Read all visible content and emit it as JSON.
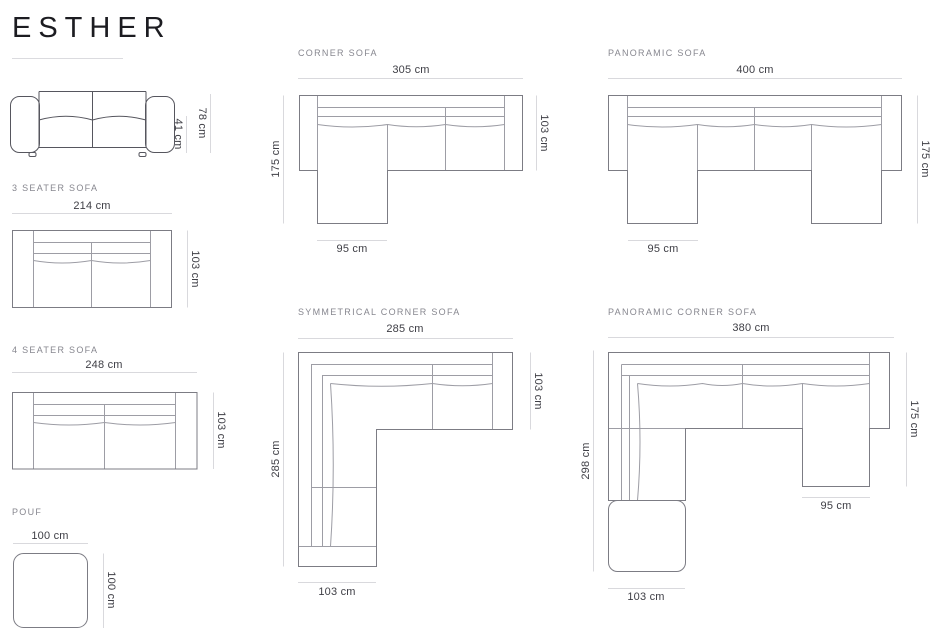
{
  "brand": {
    "title": "ESTHER"
  },
  "sections": {
    "front_view": {
      "dims": {
        "total_height": "78 cm",
        "seat_height": "41 cm"
      }
    },
    "three_seater": {
      "title": "3 SEATER SOFA",
      "dims": {
        "width": "214 cm",
        "depth": "103 cm"
      }
    },
    "four_seater": {
      "title": "4 SEATER SOFA",
      "dims": {
        "width": "248 cm",
        "depth": "103 cm"
      }
    },
    "pouf": {
      "title": "POUF",
      "dims": {
        "width": "100 cm",
        "depth": "100 cm"
      }
    },
    "corner": {
      "title": "CORNER SOFA",
      "dims": {
        "width": "305 cm",
        "left_depth": "175 cm",
        "right_depth": "103 cm",
        "chaise_width": "95 cm"
      }
    },
    "panoramic": {
      "title": "PANORAMIC SOFA",
      "dims": {
        "width": "400 cm",
        "right_depth": "175 cm",
        "chaise_width": "95 cm"
      }
    },
    "symmetrical_corner": {
      "title": "SYMMETRICAL CORNER SOFA",
      "dims": {
        "width": "285 cm",
        "left_depth": "285 cm",
        "right_depth": "103 cm",
        "bottom_width": "103 cm"
      }
    },
    "panoramic_corner": {
      "title": "PANORAMIC CORNER SOFA",
      "dims": {
        "width": "380 cm",
        "left_depth": "298 cm",
        "right_depth": "175 cm",
        "chaise_width": "95 cm",
        "bottom_width": "103 cm"
      }
    }
  }
}
